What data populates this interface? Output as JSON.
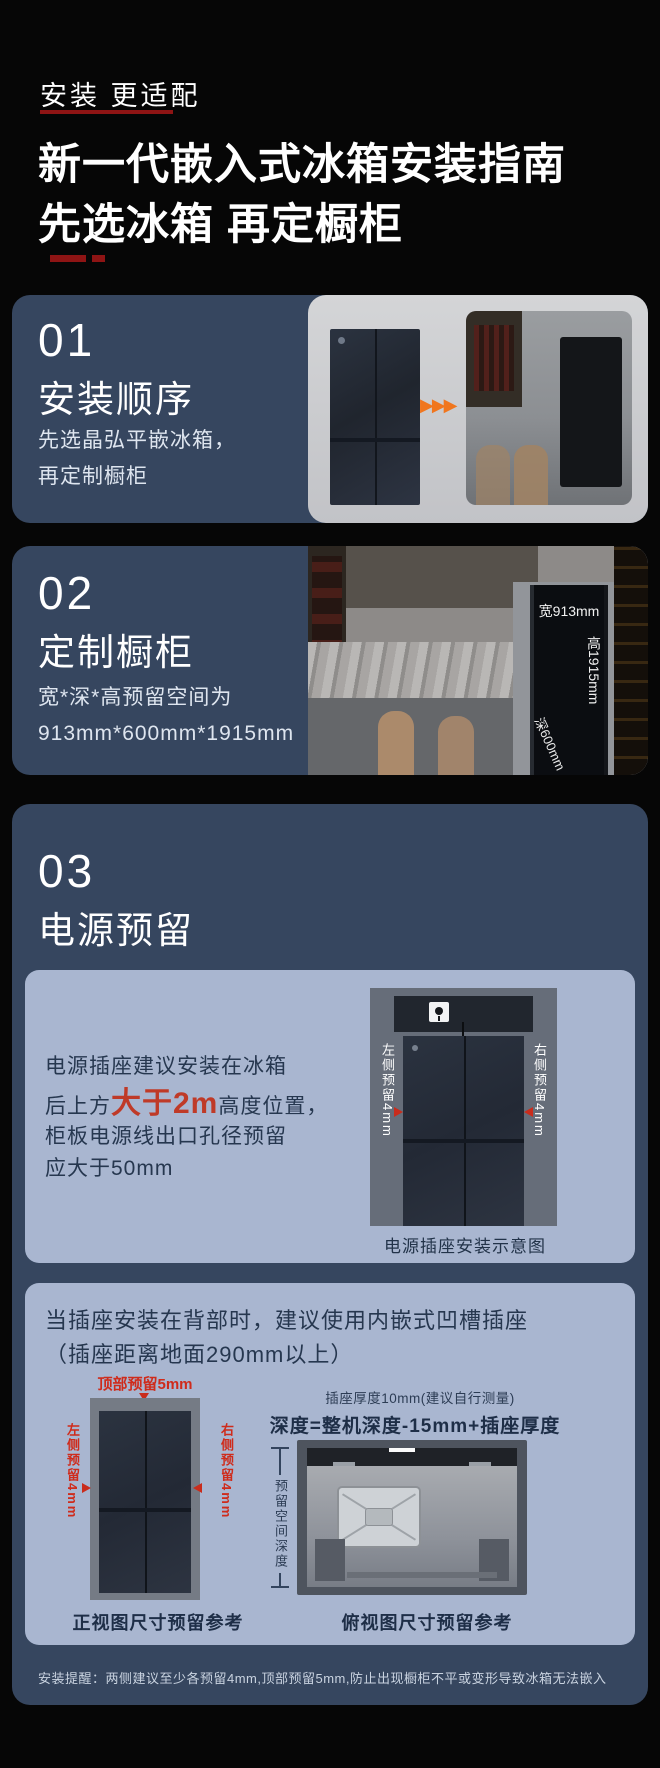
{
  "header": {
    "eyebrow": "安装 更适配",
    "title_line1": "新一代嵌入式冰箱安装指南",
    "title_line2": "先选冰箱 再定橱柜"
  },
  "section1": {
    "num": "01",
    "title": "安装顺序",
    "body_line1": "先选晶弘平嵌冰箱，",
    "body_line2": "再定制橱柜"
  },
  "section2": {
    "num": "02",
    "title": "定制橱柜",
    "body_line1": "宽*深*高预留空间为",
    "body_line2": "913mm*600mm*1915mm",
    "dim_width": "宽913mm",
    "dim_height": "高1915mm",
    "dim_depth": "深600mm"
  },
  "section3": {
    "num": "03",
    "title": "电源预留",
    "panel1": {
      "text_line1": "电源插座建议安装在冰箱",
      "text_line2_pre": "后上方",
      "text_line2_em": "大于2m",
      "text_line2_post": "高度位置，",
      "text_line3": "柜板电源线出口孔径预留",
      "text_line4": "应大于50mm",
      "label_left": "左侧预留4mm",
      "label_right": "右侧预留4mm",
      "caption": "电源插座安装示意图"
    },
    "panel2": {
      "intro_line1": "当插座安装在背部时，建议使用内嵌式凹槽插座",
      "intro_line2": "（插座距离地面290mm以上）",
      "front_view": {
        "label_top": "顶部预留5mm",
        "label_left": "左侧预留4mm",
        "label_right": "右侧预留4mm",
        "caption": "正视图尺寸预留参考"
      },
      "top_view": {
        "note": "插座厚度10mm(建议自行测量)",
        "formula": "深度=整机深度-15mm+插座厚度+插头厚度",
        "label_depth": "预留空间深度",
        "caption": "俯视图尺寸预留参考"
      }
    },
    "footnote": "安装提醒：两侧建议至少各预留4mm,顶部预留5mm,防止出现橱柜不平或变形导致冰箱无法嵌入"
  },
  "icons": {
    "triple_arrow": "▶▶▶"
  },
  "colors": {
    "page_bg": "#060606",
    "card_blue": "#36465f",
    "panel_blue": "#a9b6d0",
    "accent_red_em": "#bf3a28",
    "label_red": "#cf2b1b",
    "underline_dark_red": "#8e1414",
    "arrow_orange": "#f0761e"
  }
}
